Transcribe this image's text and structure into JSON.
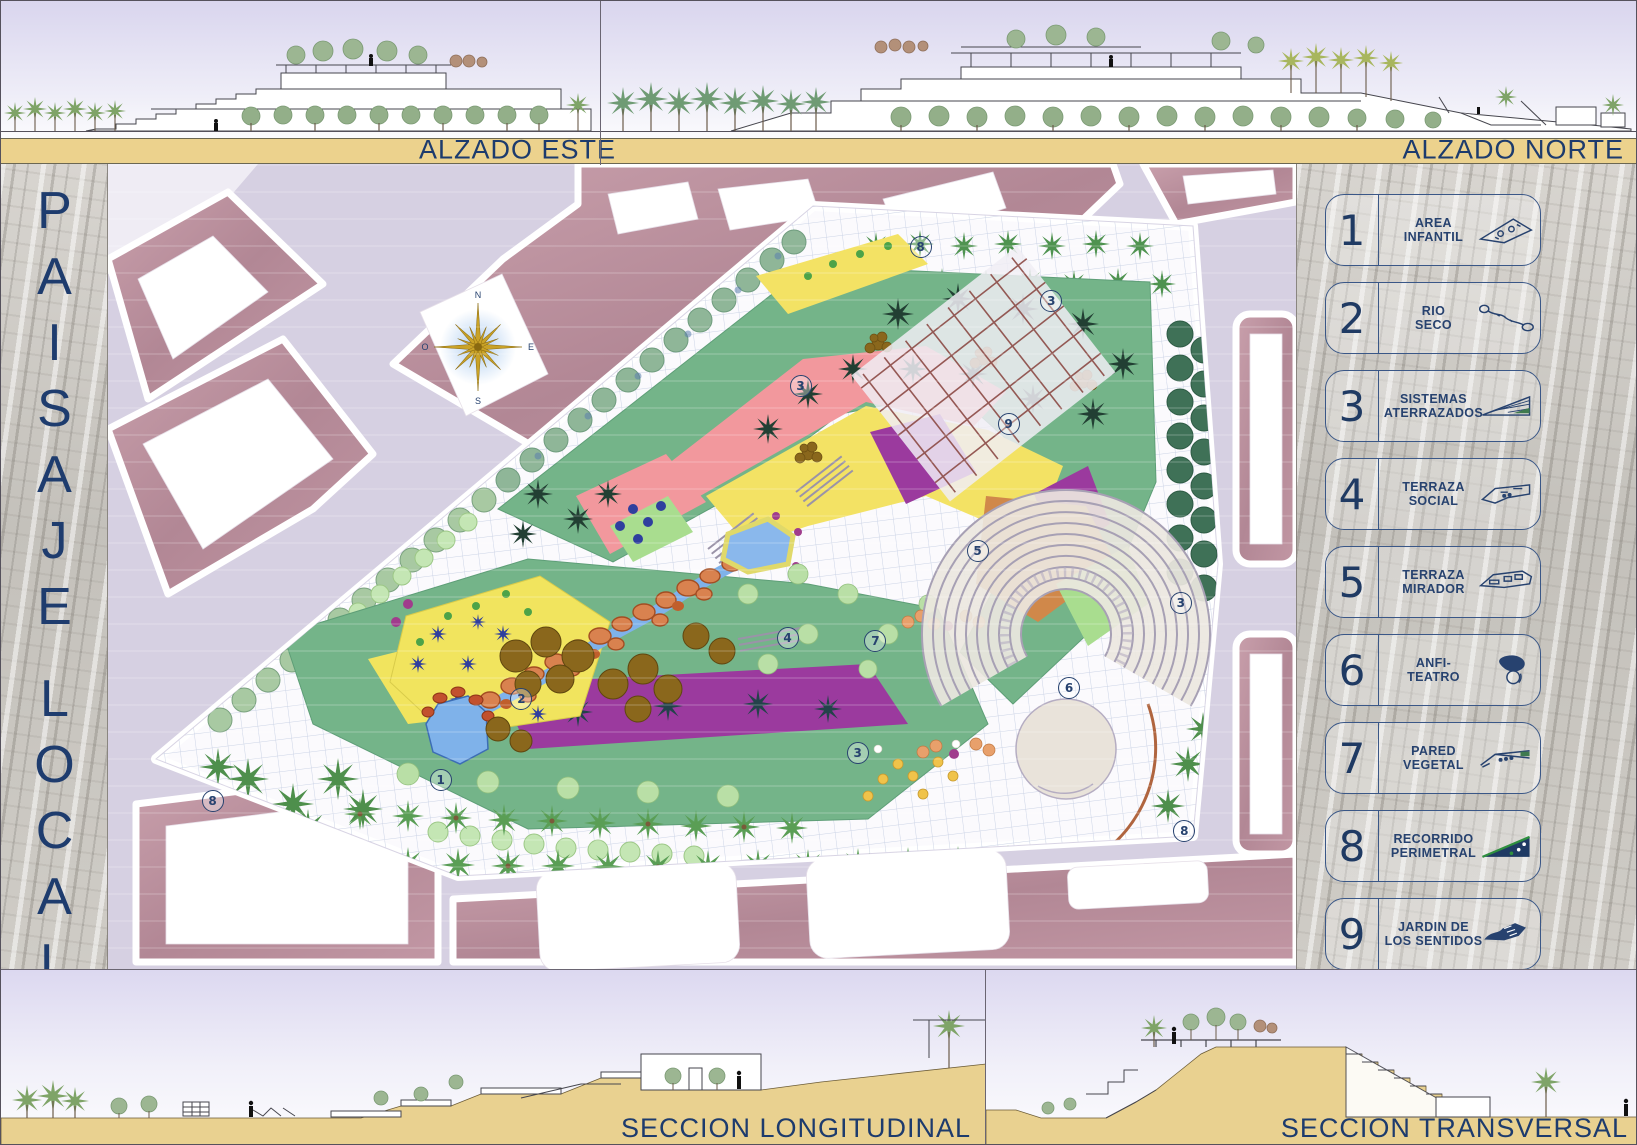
{
  "board": {
    "title": {
      "word1": "PAISAJE",
      "word2": "LOCAL"
    },
    "panel_labels": {
      "alzado_este": "ALZADO ESTE",
      "alzado_norte": "ALZADO NORTE",
      "seccion_longitudinal": "SECCION LONGITUDINAL",
      "seccion_transversal": "SECCION TRANSVERSAL"
    }
  },
  "legend": {
    "items": [
      {
        "number": "1",
        "label": "AREA\nINFANTIL",
        "icon": "area-infantil-icon"
      },
      {
        "number": "2",
        "label": "RIO\nSECO",
        "icon": "rio-seco-icon"
      },
      {
        "number": "3",
        "label": "SISTEMAS\nATERRAZADOS",
        "icon": "sistemas-aterrazados-icon"
      },
      {
        "number": "4",
        "label": "TERRAZA\nSOCIAL",
        "icon": "terraza-social-icon"
      },
      {
        "number": "5",
        "label": "TERRAZA\nMIRADOR",
        "icon": "terraza-mirador-icon"
      },
      {
        "number": "6",
        "label": "ANFI-\nTEATRO",
        "icon": "anfiteatro-icon"
      },
      {
        "number": "7",
        "label": "PARED\nVEGETAL",
        "icon": "pared-vegetal-icon"
      },
      {
        "number": "8",
        "label": "RECORRIDO\nPERIMETRAL",
        "icon": "recorrido-perimetral-icon"
      },
      {
        "number": "9",
        "label": "JARDIN DE\nLOS SENTIDOS",
        "icon": "jardin-sentidos-icon"
      }
    ]
  },
  "plan": {
    "compass": {
      "north": "N",
      "south": "S",
      "east": "E",
      "west": "O"
    },
    "markers": [
      {
        "n": "1",
        "x": 28.0,
        "y": 76.5
      },
      {
        "n": "2",
        "x": 34.8,
        "y": 66.5
      },
      {
        "n": "3",
        "x": 58.3,
        "y": 27.6
      },
      {
        "n": "3",
        "x": 79.4,
        "y": 17.0
      },
      {
        "n": "3",
        "x": 90.3,
        "y": 54.5
      },
      {
        "n": "3",
        "x": 63.1,
        "y": 73.2
      },
      {
        "n": "4",
        "x": 57.2,
        "y": 58.9
      },
      {
        "n": "5",
        "x": 73.2,
        "y": 48.1
      },
      {
        "n": "6",
        "x": 80.9,
        "y": 65.1
      },
      {
        "n": "7",
        "x": 64.6,
        "y": 59.3
      },
      {
        "n": "8",
        "x": 8.8,
        "y": 79.1
      },
      {
        "n": "8",
        "x": 68.4,
        "y": 10.3
      },
      {
        "n": "8",
        "x": 90.6,
        "y": 82.9
      },
      {
        "n": "9",
        "x": 75.8,
        "y": 32.3
      }
    ]
  },
  "colors": {
    "accent_navy": "#1E3C6E",
    "band_tan": "#ECD28D",
    "block_mauve": "#BB919E",
    "street_lavender": "#D4CEE0",
    "park_green": "#74B489",
    "zone_yellow": "#F1E45E",
    "zone_purple": "#9B3A9E",
    "zone_salmon": "#F2989D",
    "zone_orange": "#D0884A",
    "water_blue": "#7FB2EA",
    "section_sand": "#E9D190"
  }
}
